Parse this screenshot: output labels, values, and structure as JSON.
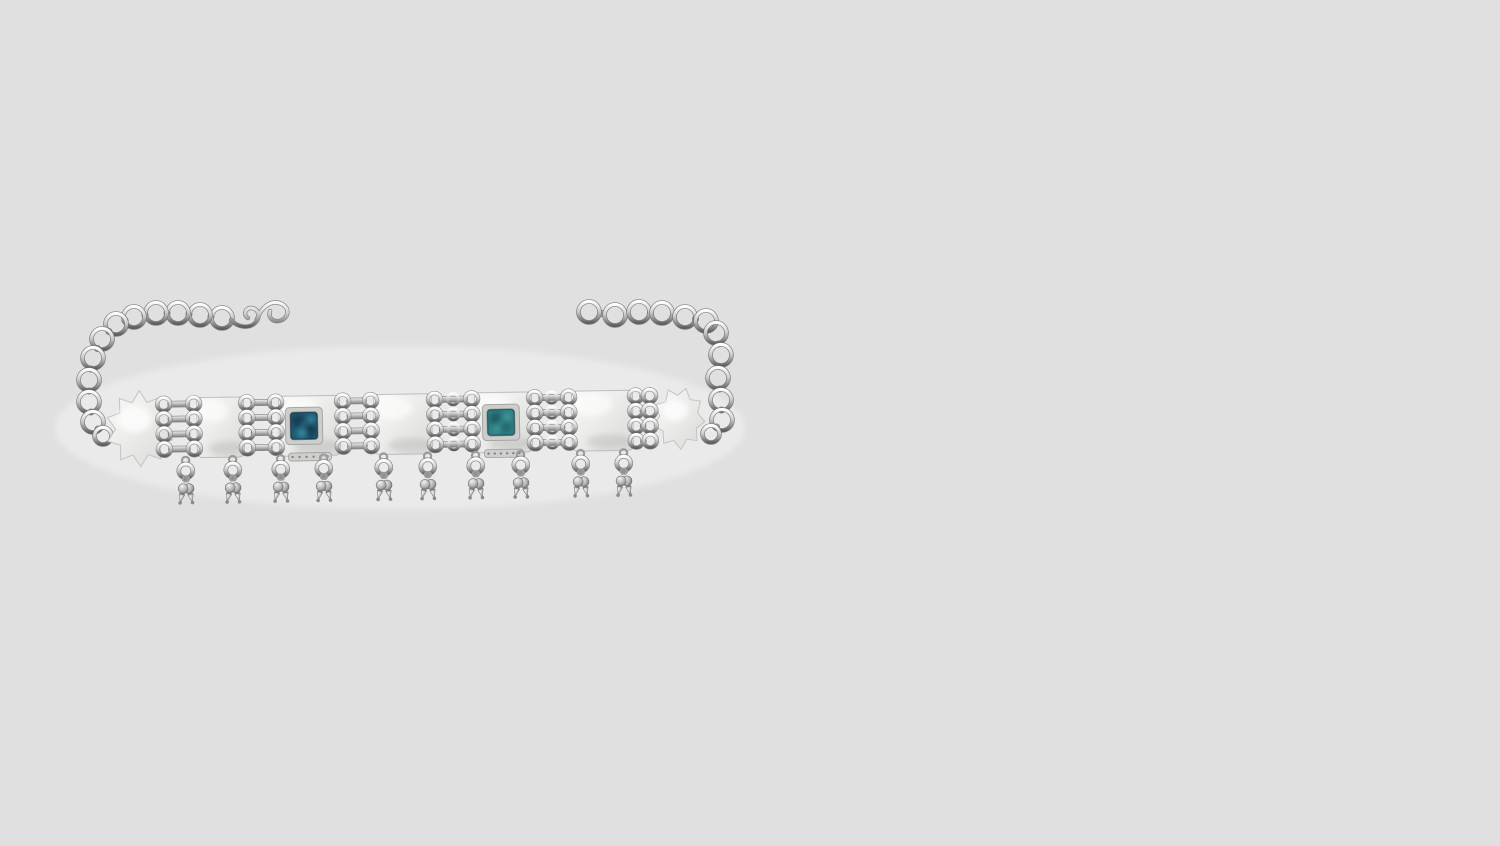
{
  "meta": {
    "description": "Product photograph of an oxidized silver choker necklace with two square turquoise inlays and rows of hanging silver bead tassels, laid flat on a plain light-gray backdrop"
  },
  "scene": {
    "background": "#e0e0e0",
    "palette": {
      "silver_highlight": "#fdfdfd",
      "silver_light": "#efefef",
      "silver_mid": "#c2c2c2",
      "silver_deep": "#8f8f8f",
      "silver_dark": "#5f5f5f",
      "plate_light": "#f9f9f7",
      "plate_mid": "#ececea",
      "plate_dark": "#d9d9d7",
      "outline": "#6f6f6f",
      "stone1_base": "#1e5a72",
      "stone1_dark": "#14384f",
      "stone1_light": "#3e93ac",
      "stone2_base": "#2e7f86",
      "stone2_dark": "#1e565c",
      "stone2_light": "#4aa0a2"
    },
    "glow": {
      "cx": 400,
      "cy": 428,
      "rx": 345,
      "ry": 82,
      "opacity": 0.32
    },
    "chain_left": {
      "ring_radius": 10.5,
      "rings": [
        [
          222,
          318
        ],
        [
          200,
          315
        ],
        [
          178,
          313
        ],
        [
          156,
          313
        ],
        [
          134,
          317
        ],
        [
          116,
          324
        ],
        [
          102,
          339
        ],
        [
          93,
          358
        ],
        [
          89,
          380
        ],
        [
          89,
          402
        ],
        [
          93,
          422
        ],
        [
          103,
          436
        ]
      ]
    },
    "chain_right": {
      "ring_radius": 10.5,
      "rings": [
        [
          589,
          312
        ],
        [
          615,
          315
        ],
        [
          639,
          312
        ],
        [
          662,
          313
        ],
        [
          685,
          317
        ],
        [
          706,
          321
        ],
        [
          716,
          333
        ],
        [
          721,
          355
        ],
        [
          718,
          378
        ],
        [
          721,
          400
        ],
        [
          722,
          420
        ],
        [
          711,
          434
        ]
      ]
    },
    "clasp_path": "M231 320 C238 328 250 329 256 322 C261 316 258 308 251 308 C245 308 243 315 248 318 M256 322 C261 306 272 299 282 304 C291 309 288 319 279 321 C272 322 268 317 270 311",
    "band": {
      "tilt": -1.0,
      "pivot": [
        410,
        424
      ],
      "plate_top": 394,
      "plate_bottom": 454,
      "link_rows": [
        400,
        415,
        430,
        445
      ],
      "stars": [
        {
          "cx": 140,
          "cy": 424,
          "rx": 34,
          "ry": 38,
          "points": 10,
          "inner": 0.72,
          "phase": 0.31
        },
        {
          "cx": 679,
          "cy": 423,
          "rx": 26,
          "ry": 31,
          "points": 9,
          "inner": 0.74,
          "phase": 0.12
        }
      ],
      "links": [
        {
          "x": 156,
          "w": 46
        },
        {
          "x": 239,
          "w": 45
        },
        {
          "x": 335,
          "w": 44
        },
        {
          "x": 427,
          "w": 53
        },
        {
          "x": 527,
          "w": 50
        },
        {
          "x": 628,
          "w": 30
        }
      ],
      "plates": [
        {
          "x": 199,
          "w": 43,
          "stone": null
        },
        {
          "x": 281,
          "w": 57,
          "stone": 0
        },
        {
          "x": 376,
          "w": 54,
          "stone": null
        },
        {
          "x": 477,
          "w": 53,
          "stone": 1
        },
        {
          "x": 574,
          "w": 57,
          "stone": null
        }
      ],
      "stones": [
        {
          "cx": 304,
          "cy": 424,
          "w": 27,
          "h": 27,
          "base": "#1e5a72",
          "blobs": [
            [
              -6,
              -5,
              6,
              "#14384f",
              0.9
            ],
            [
              5,
              4,
              7,
              "#123349",
              0.8
            ],
            [
              -2,
              7,
              5,
              "#3e93ac",
              0.9
            ],
            [
              7,
              -6,
              4,
              "#3e93ac",
              0.85
            ],
            [
              0,
              -1,
              3,
              "#2e7d8e",
              0.9
            ]
          ]
        },
        {
          "cx": 501,
          "cy": 424,
          "w": 27,
          "h": 26,
          "base": "#2e7f86",
          "blobs": [
            [
              -5,
              -4,
              6,
              "#1e565c",
              0.85
            ],
            [
              4,
              4,
              6,
              "#226066",
              0.8
            ],
            [
              6,
              -5,
              4,
              "#4aa0a2",
              0.9
            ],
            [
              -4,
              6,
              4,
              "#4aa0a2",
              0.85
            ],
            [
              0,
              0,
              3,
              "#3b8f93",
              0.9
            ]
          ]
        }
      ]
    },
    "dangles": {
      "xs": [
        185,
        232,
        280,
        323,
        383,
        427,
        475,
        520,
        580,
        623
      ],
      "top_y": 452,
      "spread_deg": 13
    }
  }
}
